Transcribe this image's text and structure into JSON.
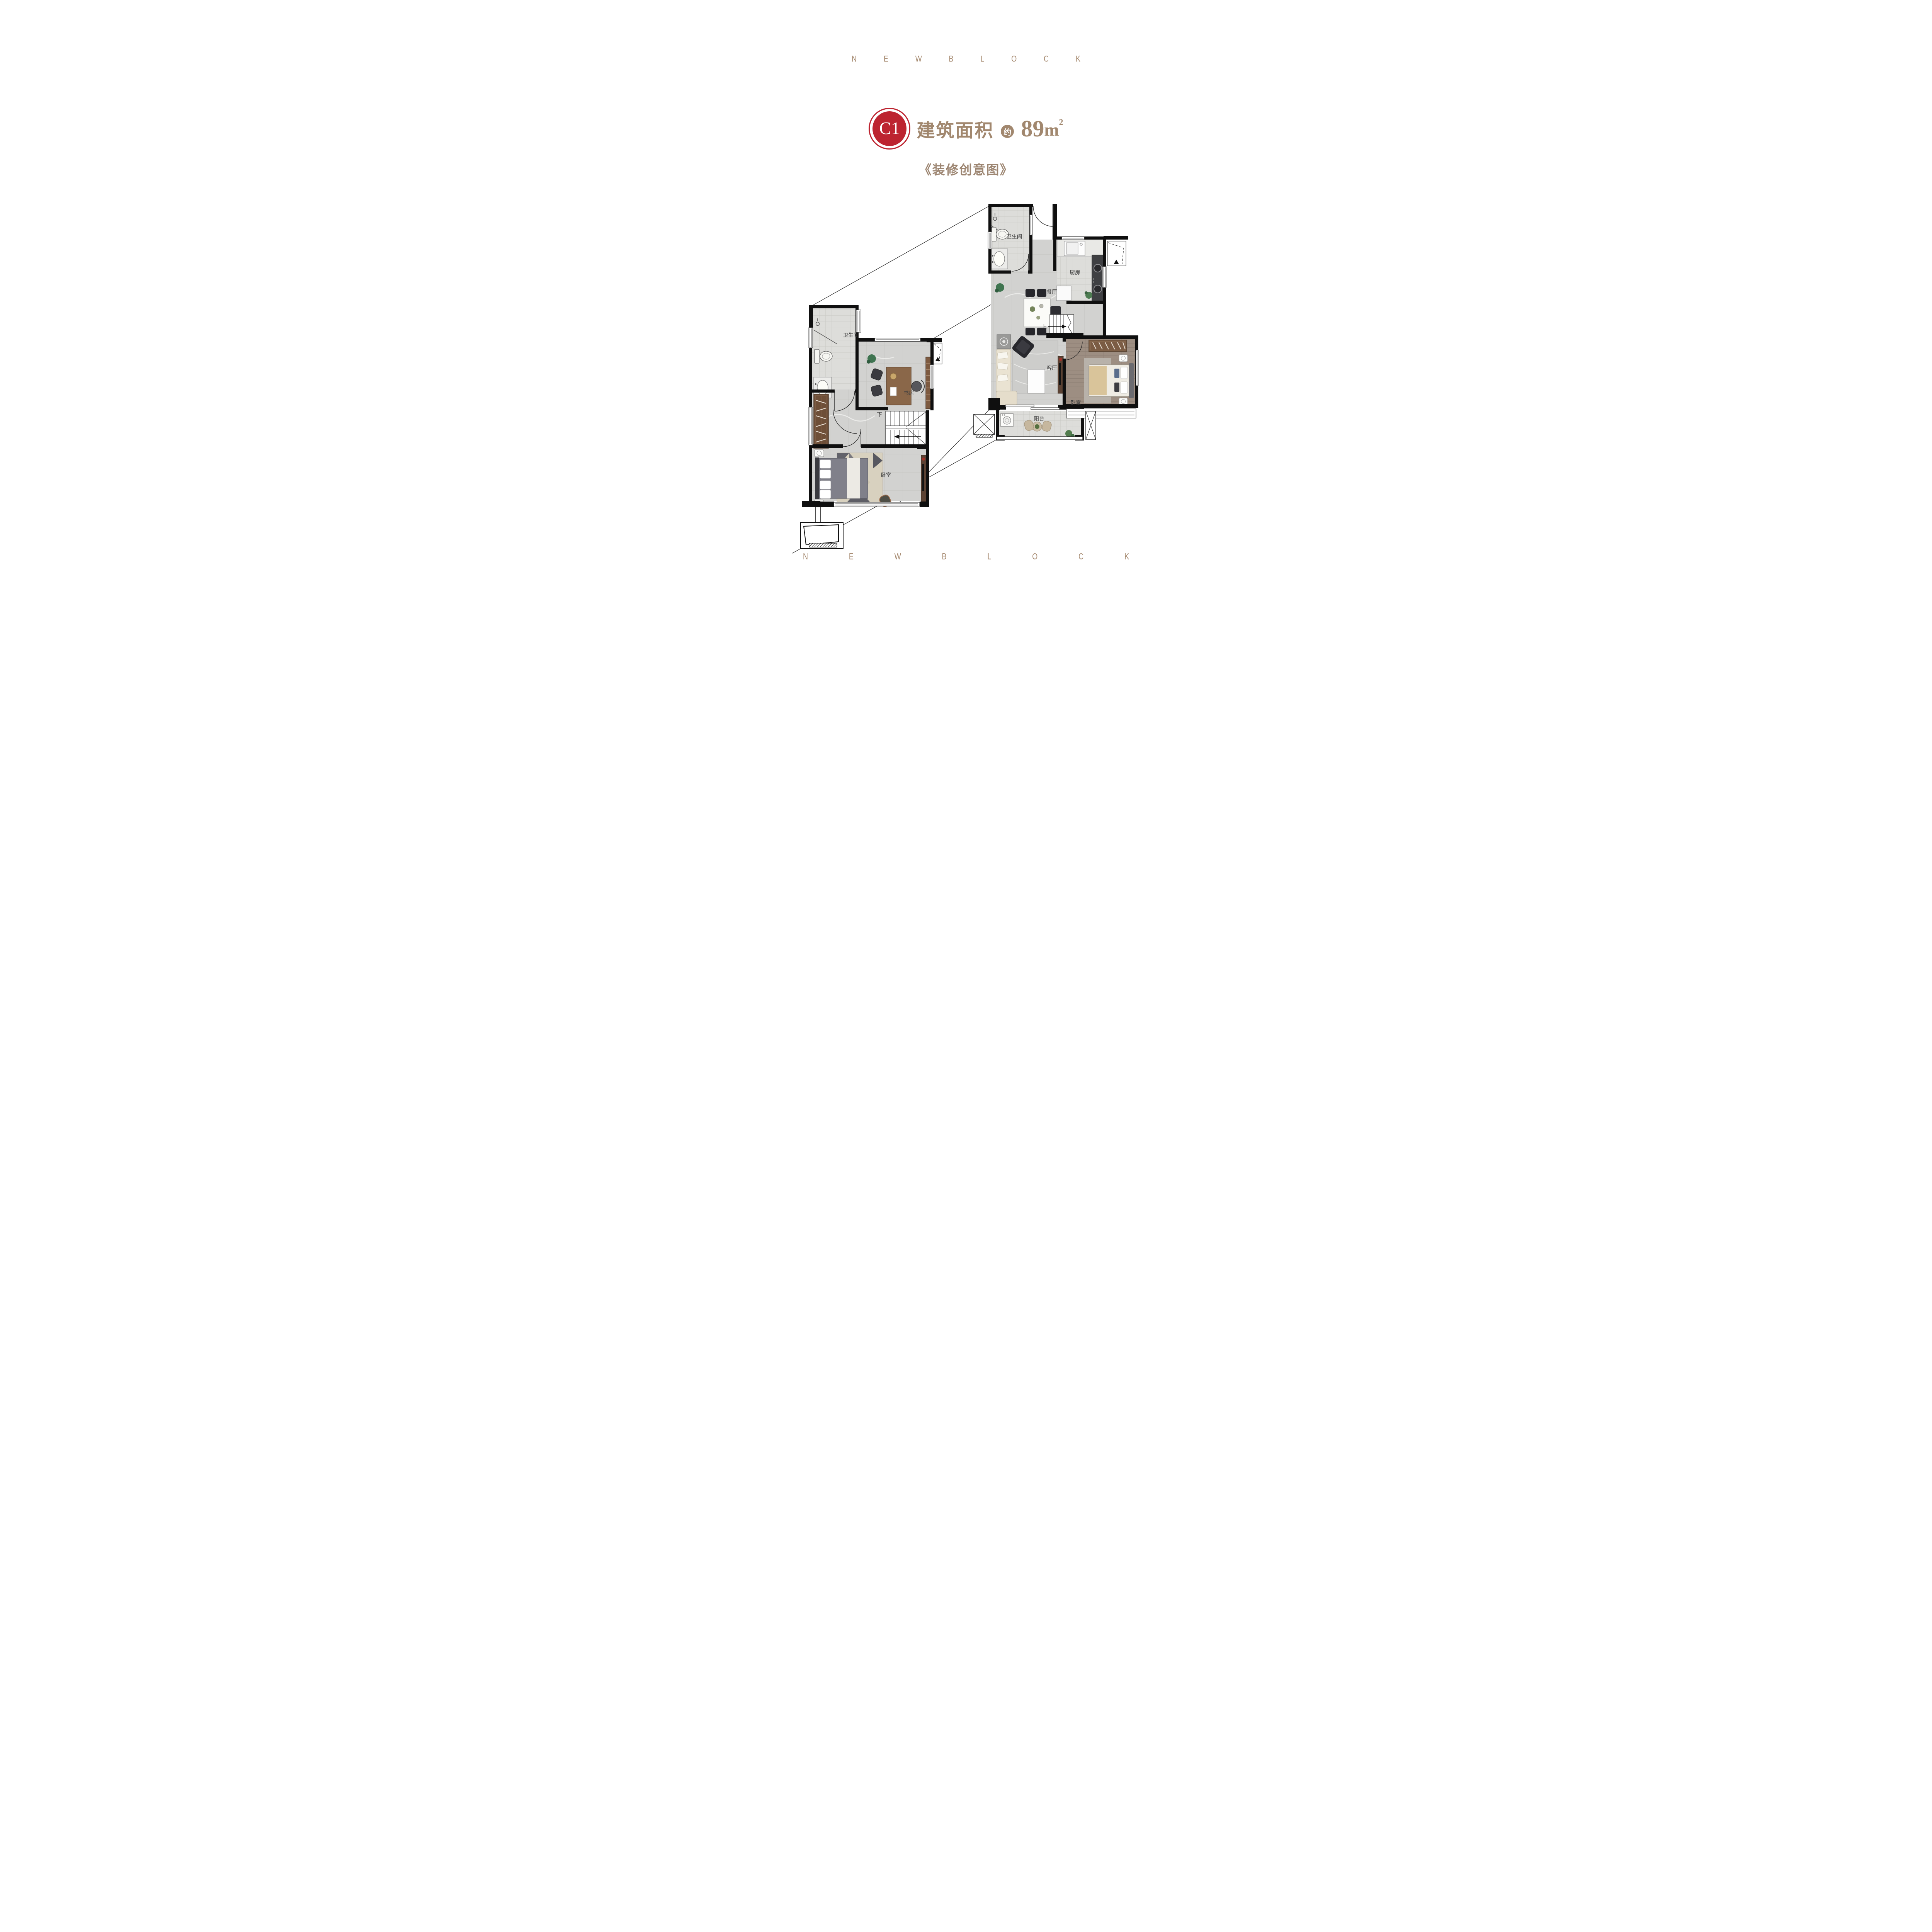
{
  "colors": {
    "brand_tan": "#a5896f",
    "title_tan": "#a1876e",
    "badge_red": "#bd2430",
    "subtitle_tan": "#9d8672",
    "room_label_gray": "#3f3f3f",
    "wall_black": "#0f0f0f"
  },
  "header": {
    "brand_letters": [
      "N",
      "E",
      "W",
      "B",
      "L",
      "O",
      "C",
      "K"
    ]
  },
  "title": {
    "unit_code": "C1",
    "area_label": "建筑面积",
    "approx_badge": "约",
    "area_value": "89",
    "area_unit": "m",
    "area_sup": "2"
  },
  "subtitle": {
    "text": "《装修创意图》"
  },
  "floor_plans": {
    "first_floor": {
      "bathroom": "卫生间",
      "kitchen": "厨房",
      "dining": "餐厅",
      "stairs_up": "上",
      "living": "客厅",
      "bedroom": "卧室",
      "balcony": "阳台"
    },
    "second_floor": {
      "bathroom": "卫生间",
      "study": "书房",
      "stairs_down": "下",
      "bedroom": "卧室"
    }
  },
  "footer": {
    "brand_letters": [
      "N",
      "E",
      "W",
      "B",
      "L",
      "O",
      "C",
      "K"
    ]
  }
}
